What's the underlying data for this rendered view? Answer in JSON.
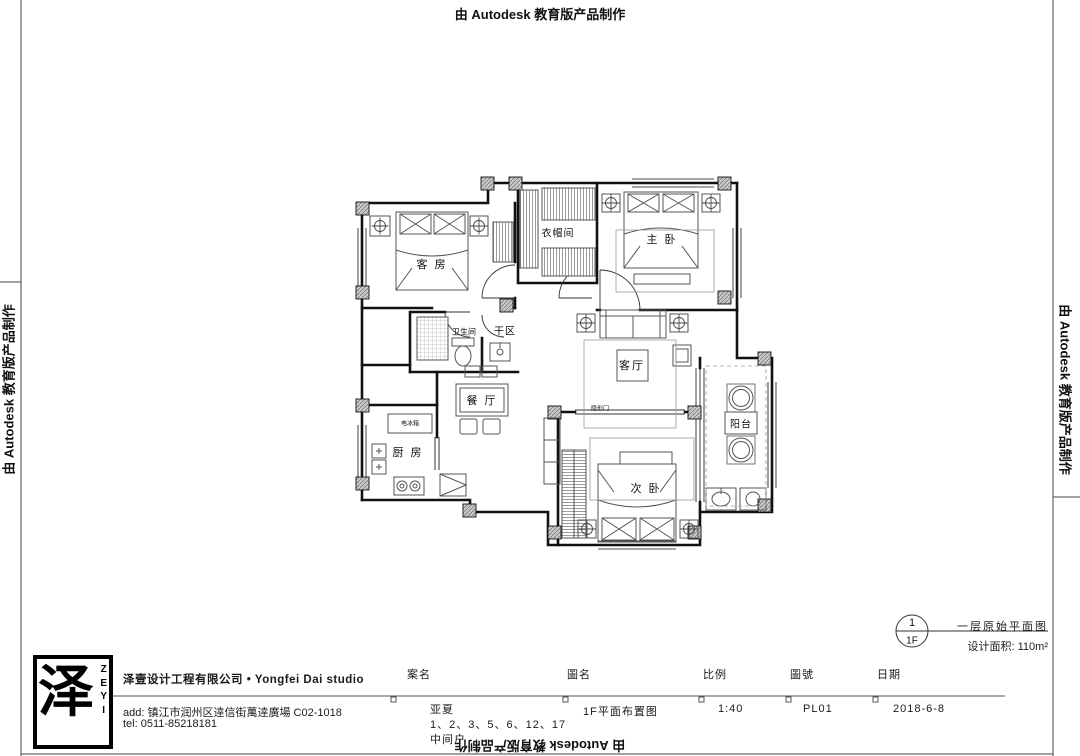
{
  "watermark": {
    "text": "由 Autodesk 教育版产品制作"
  },
  "plan": {
    "rooms": {
      "guest": "客 房",
      "cloak": "衣帽间",
      "master": "主 卧",
      "bath": "卫生间",
      "dry": "干区",
      "living": "客厅",
      "dining": "餐 厅",
      "kitchen": "厨 房",
      "second": "次 卧",
      "balcony": "阳台"
    },
    "small_labels": {
      "fridge": "电冰箱",
      "hidden_door": "隐形门"
    }
  },
  "detail_marker": {
    "number": "1",
    "floor": "1F",
    "name": "一层原始平面图",
    "area": "设计面积: 110m²"
  },
  "title_block": {
    "logo": {
      "glyph": "泽",
      "latin_letters": [
        "Z",
        "E",
        "Y",
        "I"
      ]
    },
    "company": "泽壹设计工程有限公司 • Yongfei Dai studio",
    "address": "add: 镇江市润州区逹信街萬逹廣場 C02-1018",
    "tel": "tel: 0511-85218181",
    "headers": {
      "project": "案名",
      "drawing": "圖名",
      "scale": "比例",
      "number": "圖號",
      "date": "日期"
    },
    "values": {
      "project_line1": "亚夏",
      "project_line2": "1、2、3、5、6、12、17",
      "project_line3": "中间户",
      "drawing": "1F平面布置图",
      "scale": "1:40",
      "number": "PL01",
      "date": "2018-6-8"
    }
  }
}
